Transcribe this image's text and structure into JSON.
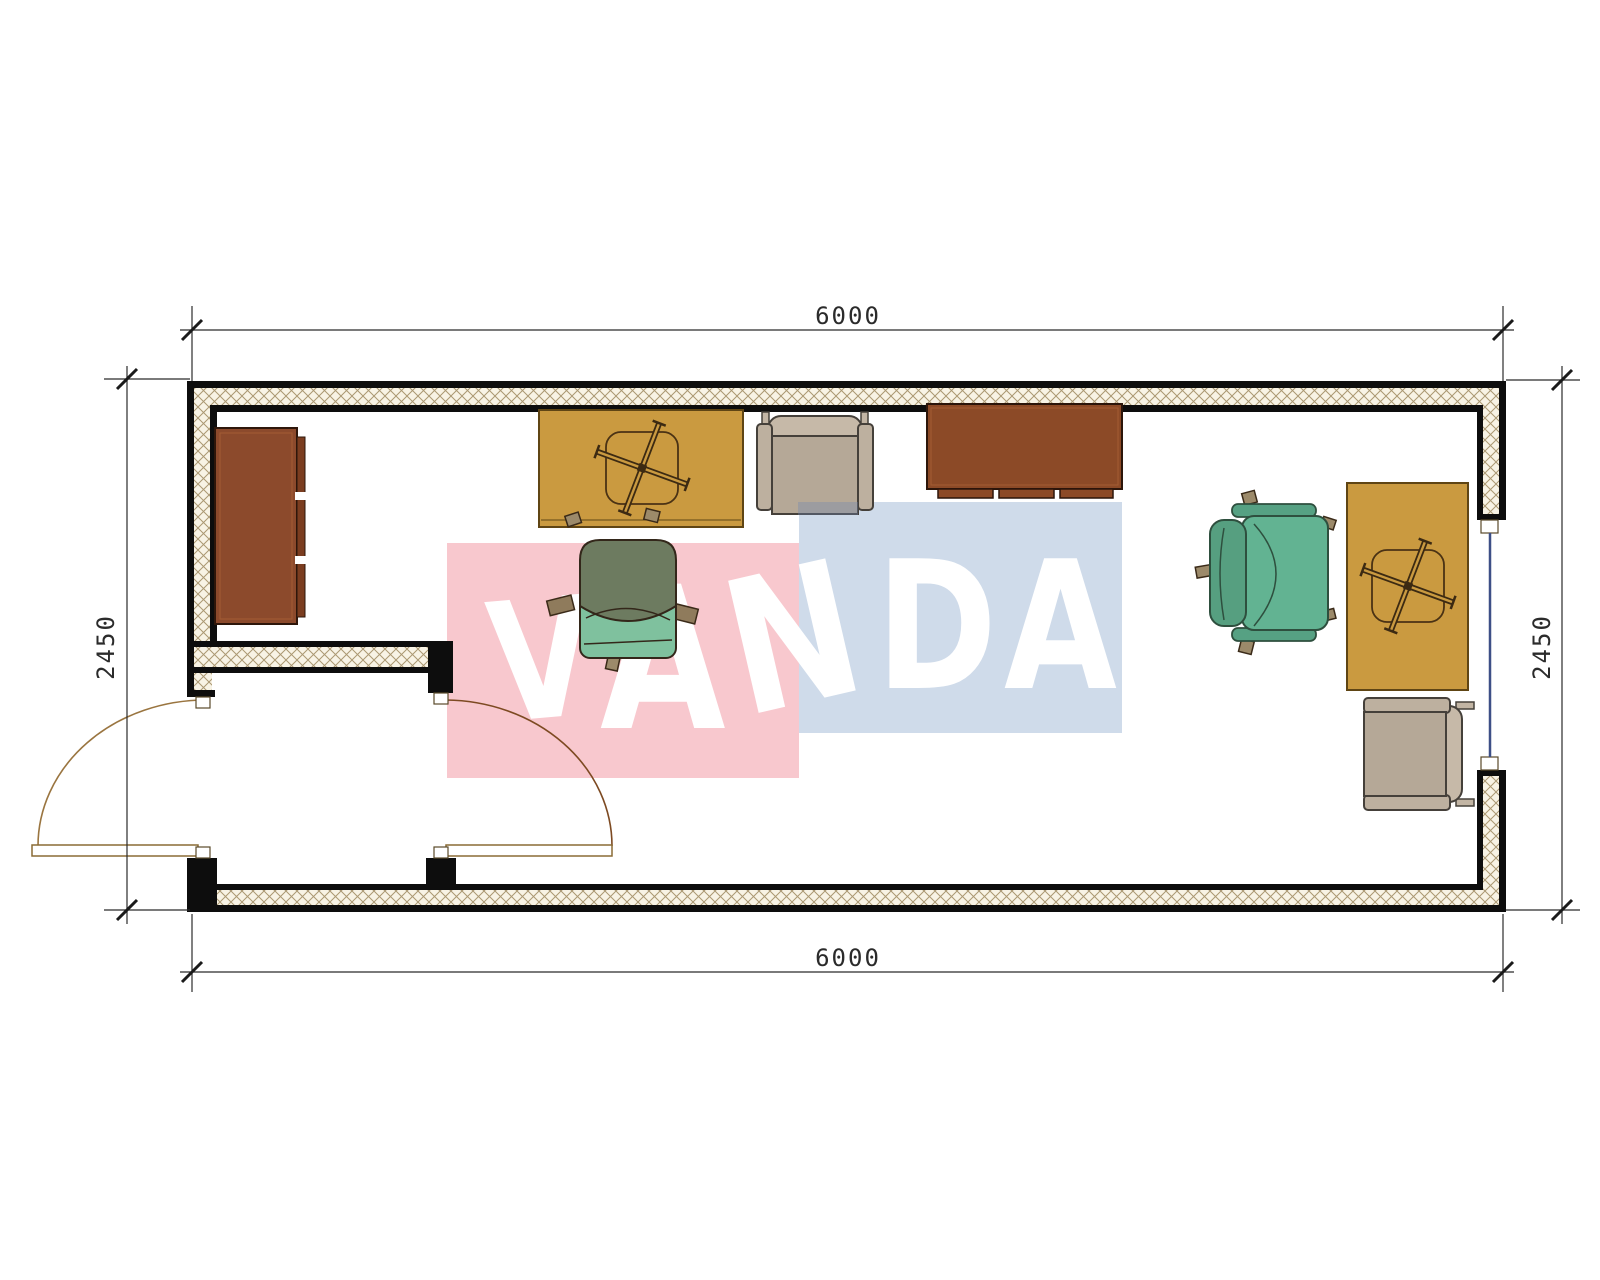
{
  "page": {
    "type": "architectural floor plan drawing"
  },
  "dimensions": {
    "top": "6000",
    "bottom": "6000",
    "left": "2450",
    "right": "2450"
  },
  "watermark": {
    "text": "VANDA",
    "letters": [
      "V",
      "A",
      "N",
      "D",
      "A"
    ],
    "block_red": "#f8c8ce",
    "block_blue": "#cfdbea",
    "letter_color": "#ffffff"
  },
  "colors": {
    "wall_line": "#0d0d0d",
    "wall_hatch_bg": "#f8f3e5",
    "wall_hatch_line": "#ab9872",
    "desk_orange": "#ca9a40",
    "cabinet_brown": "#8c4a2c",
    "table_brown": "#8c4a27",
    "chair_back_olive": "#6d7b60",
    "chair_seat_mint": "#7fc19e",
    "chair_green_seat": "#62b392",
    "chair_green_back": "#569f80",
    "armchair_taupe": "#b5a897",
    "armchair_trim": "#c6b9a8",
    "door_arc": "#7d4a22",
    "window_glass": "#3d4f86",
    "dim_line": "#2b2b2b"
  }
}
